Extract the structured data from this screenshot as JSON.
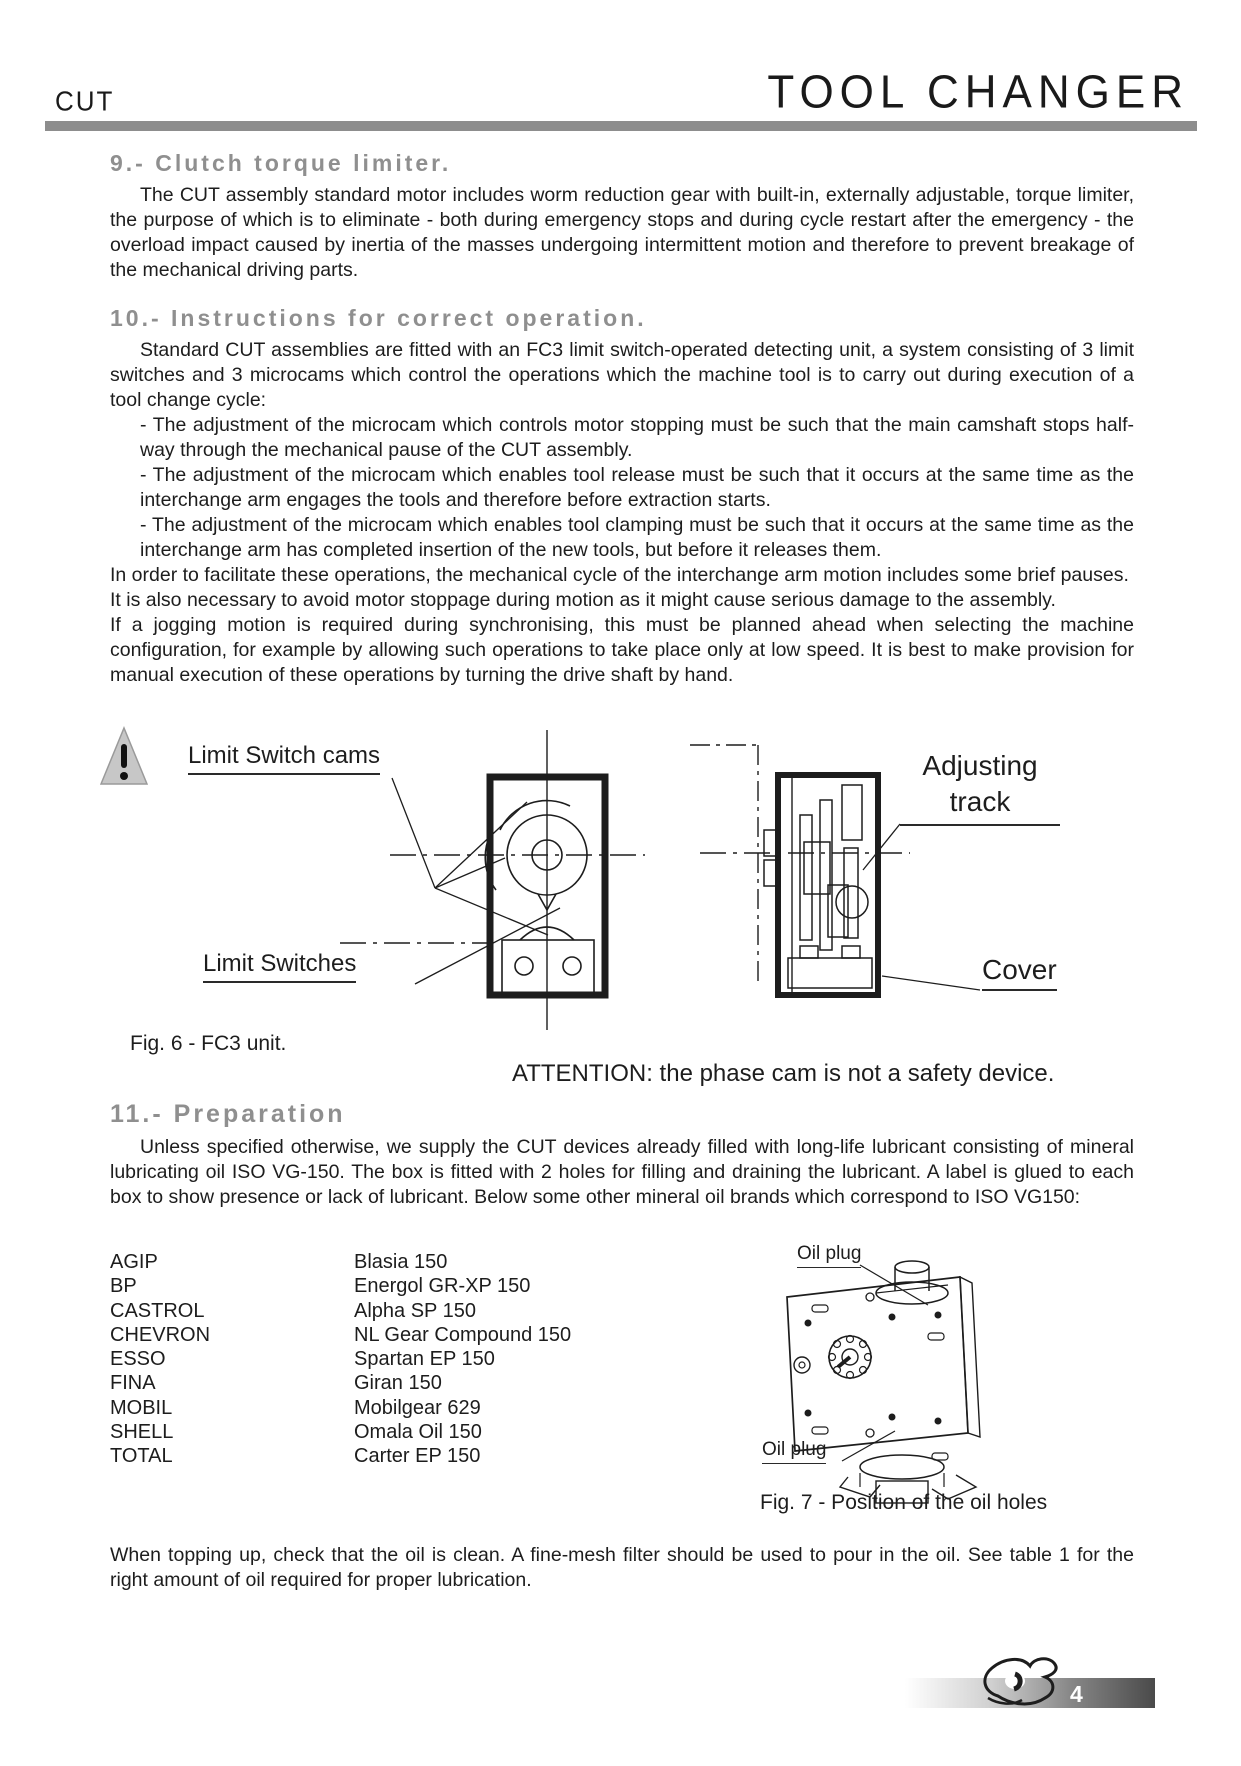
{
  "header": {
    "model": "CUT",
    "title": "TOOL CHANGER"
  },
  "section9": {
    "heading": "9.- Clutch torque limiter.",
    "body": "The CUT assembly standard motor includes worm reduction gear with built-in, externally adjustable, torque limiter, the purpose of which is to eliminate - both during emergency stops and during cycle restart after the emergency - the overload impact caused by inertia of the masses undergoing intermittent motion and therefore to prevent breakage of the mechanical driving parts."
  },
  "section10": {
    "heading": "10.- Instructions for correct operation.",
    "intro": "Standard CUT assemblies are fitted with an FC3 limit switch-operated detecting unit, a system consisting of 3 limit switches and 3 microcams which control the operations which the machine tool is to carry out during execution of a tool change cycle:",
    "bullets": [
      "- The adjustment of the microcam which controls motor stopping must be such that the main camshaft stops half-way through the mechanical pause of the CUT assembly.",
      "- The adjustment of the microcam which enables tool release must be such that it occurs at the same time as the interchange arm engages the tools and therefore before extraction starts.",
      "- The adjustment of the microcam which enables tool clamping must be such that it occurs at the same time as the interchange arm has completed insertion of the new tools, but before it releases them."
    ],
    "paragraphs": [
      "In order to facilitate these operations, the mechanical cycle of the interchange arm motion includes some brief pauses.",
      "It is also necessary to avoid motor stoppage during motion as it might cause serious damage to the assembly.",
      "If a jogging motion is required during synchronising, this must be planned ahead when selecting the machine configuration, for example by allowing such operations to take place only at low speed. It is best to make provision for manual execution of these operations by turning the drive shaft by hand."
    ]
  },
  "figure6": {
    "caption": "Fig. 6 - FC3 unit.",
    "label_cams": "Limit Switch cams",
    "label_switches": "Limit Switches",
    "label_track": "Adjusting track",
    "label_cover": "Cover"
  },
  "attention": {
    "text": "ATTENTION: the phase cam is not a safety device."
  },
  "section11": {
    "heading": "11.- Preparation",
    "body": "Unless specified otherwise, we supply the CUT devices already filled with long-life lubricant consisting of mineral lubricating oil ISO VG-150. The box is fitted with 2 holes for filling and draining the lubricant. A label is glued to each box to show presence or lack of lubricant. Below some other mineral oil brands which correspond to ISO VG150:"
  },
  "oil_brands": {
    "rows": [
      {
        "brand": "AGIP",
        "product": "Blasia 150"
      },
      {
        "brand": "BP",
        "product": "Energol GR-XP 150"
      },
      {
        "brand": "CASTROL",
        "product": "Alpha SP 150"
      },
      {
        "brand": "CHEVRON",
        "product": "NL Gear Compound 150"
      },
      {
        "brand": "ESSO",
        "product": "Spartan EP 150"
      },
      {
        "brand": "FINA",
        "product": "Giran 150"
      },
      {
        "brand": "MOBIL",
        "product": "Mobilgear 629"
      },
      {
        "brand": "SHELL",
        "product": "Omala Oil 150"
      },
      {
        "brand": "TOTAL",
        "product": "Carter EP 150"
      }
    ]
  },
  "figure7": {
    "caption": "Fig. 7 - Position of the oil holes",
    "label_oil_plug_top": "Oil plug",
    "label_oil_plug_bottom": "Oil plug"
  },
  "closing": {
    "body": "When topping up, check that the oil is clean. A fine-mesh filter should be used to pour in the oil. See table 1 for the right amount of oil required for proper lubrication."
  },
  "footer": {
    "page_number": "4"
  }
}
